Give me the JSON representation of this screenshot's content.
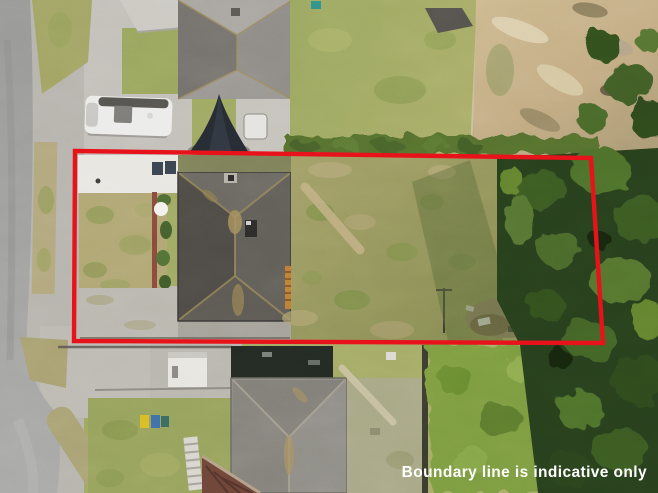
{
  "overlay": {
    "disclaimer": "Boundary line is indicative only",
    "disclaimer_color": "#FFFFFF",
    "boundary_color": "#E8121A"
  }
}
